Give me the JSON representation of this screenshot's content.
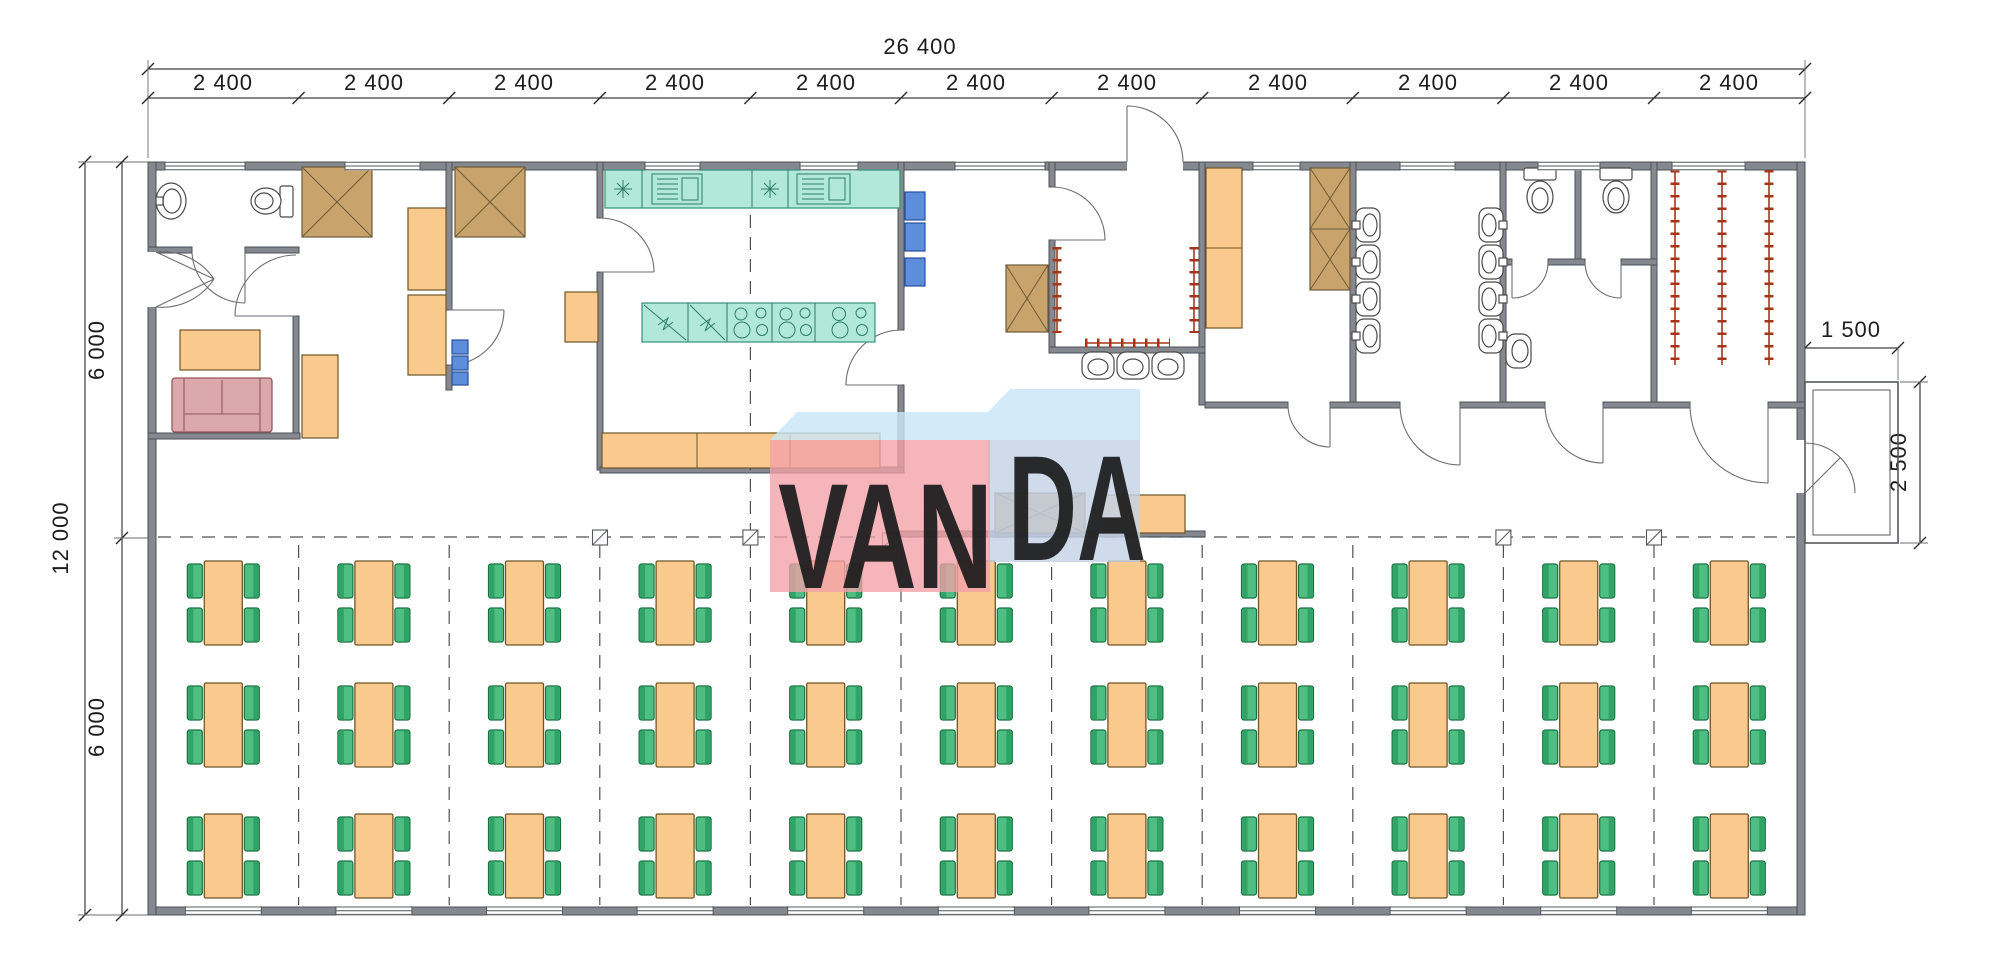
{
  "watermark": {
    "brand": "VANDA",
    "part1": "VAN",
    "part2": "DA",
    "panel_color": "#F2A0A8",
    "box_top_color": "#C9E6F7",
    "box_side_color": "#C4D3E6",
    "letter_color": "#FFFFFF"
  },
  "dimensions": {
    "overall_width_label": "26 400",
    "bay_labels": [
      "2 400",
      "2 400",
      "2 400",
      "2 400",
      "2 400",
      "2 400",
      "2 400",
      "2 400",
      "2 400",
      "2 400",
      "2 400"
    ],
    "overall_height_label": "12 000",
    "height_segment_labels": [
      "6 000",
      "6 000"
    ],
    "porch_width_label": "1 500",
    "porch_depth_label": "2 500"
  },
  "dining_area": {
    "table_rows": 3,
    "table_columns": 11,
    "table_count": 33,
    "chairs_per_table": 4,
    "table_color": "#F9C98E",
    "chair_color": "#4FBE82",
    "chair_accent_color": "#2FA466"
  },
  "palette": {
    "wall": "#85888F",
    "counter_teal": "#B2E8D9",
    "cabinet_orange": "#F9C98E",
    "wardrobe_brown": "#C8A36B",
    "shelf_blue": "#5C8EDC",
    "sofa_pink": "#DBA9AB",
    "coat_rail_red": "#A63518",
    "background": "#FFFFFF"
  }
}
